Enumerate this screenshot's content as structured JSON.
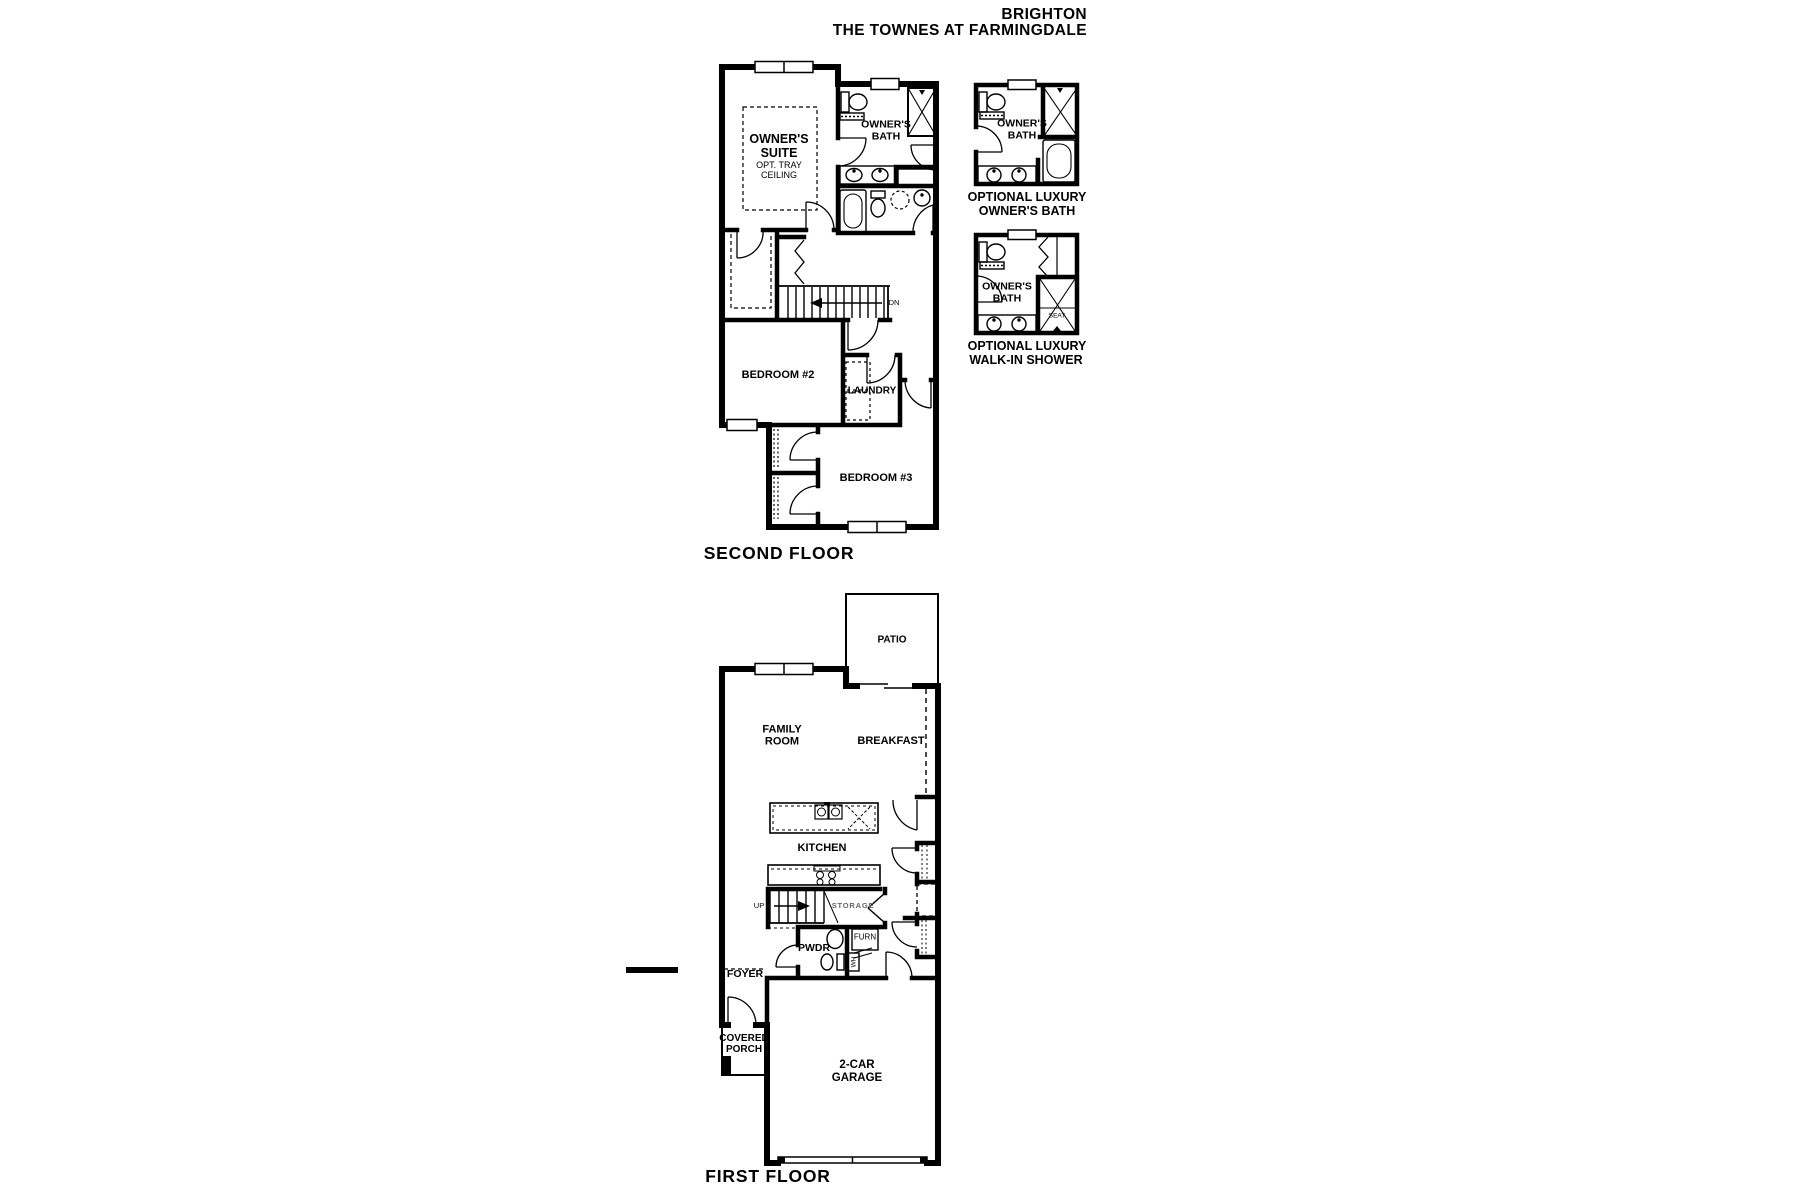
{
  "title": {
    "line1": "BRIGHTON",
    "line2": "THE TOWNES AT FARMINGDALE"
  },
  "second_floor": {
    "caption": "SECOND FLOOR",
    "owners_suite": "OWNER'S SUITE",
    "owners_suite_note": "OPT. TRAY CEILING",
    "owners_bath": "OWNER'S BATH",
    "bedroom2": "BEDROOM #2",
    "bedroom3": "BEDROOM #3",
    "laundry": "LAUNDRY",
    "stair_direction": "DN"
  },
  "optional_owners_bath": {
    "room": "OWNER'S BATH",
    "caption_line1": "OPTIONAL LUXURY",
    "caption_line2": "OWNER'S BATH"
  },
  "optional_walk_in_shower": {
    "room": "OWNER'S BATH",
    "seat": "SEAT",
    "caption_line1": "OPTIONAL LUXURY",
    "caption_line2": "WALK-IN SHOWER"
  },
  "first_floor": {
    "caption": "FIRST FLOOR",
    "patio": "PATIO",
    "family_room": "FAMILY ROOM",
    "breakfast": "BREAKFAST",
    "kitchen": "KITCHEN",
    "storage": "STORAGE",
    "powder": "PWDR",
    "furnace": "FURN",
    "water_heater": "WH",
    "stair_direction": "UP",
    "foyer": "FOYER",
    "covered_porch": "COVERED PORCH",
    "garage": "2-CAR GARAGE"
  },
  "colors": {
    "wall": "#000000",
    "background": "#ffffff",
    "text": "#000000",
    "muted_text": "#666666"
  }
}
